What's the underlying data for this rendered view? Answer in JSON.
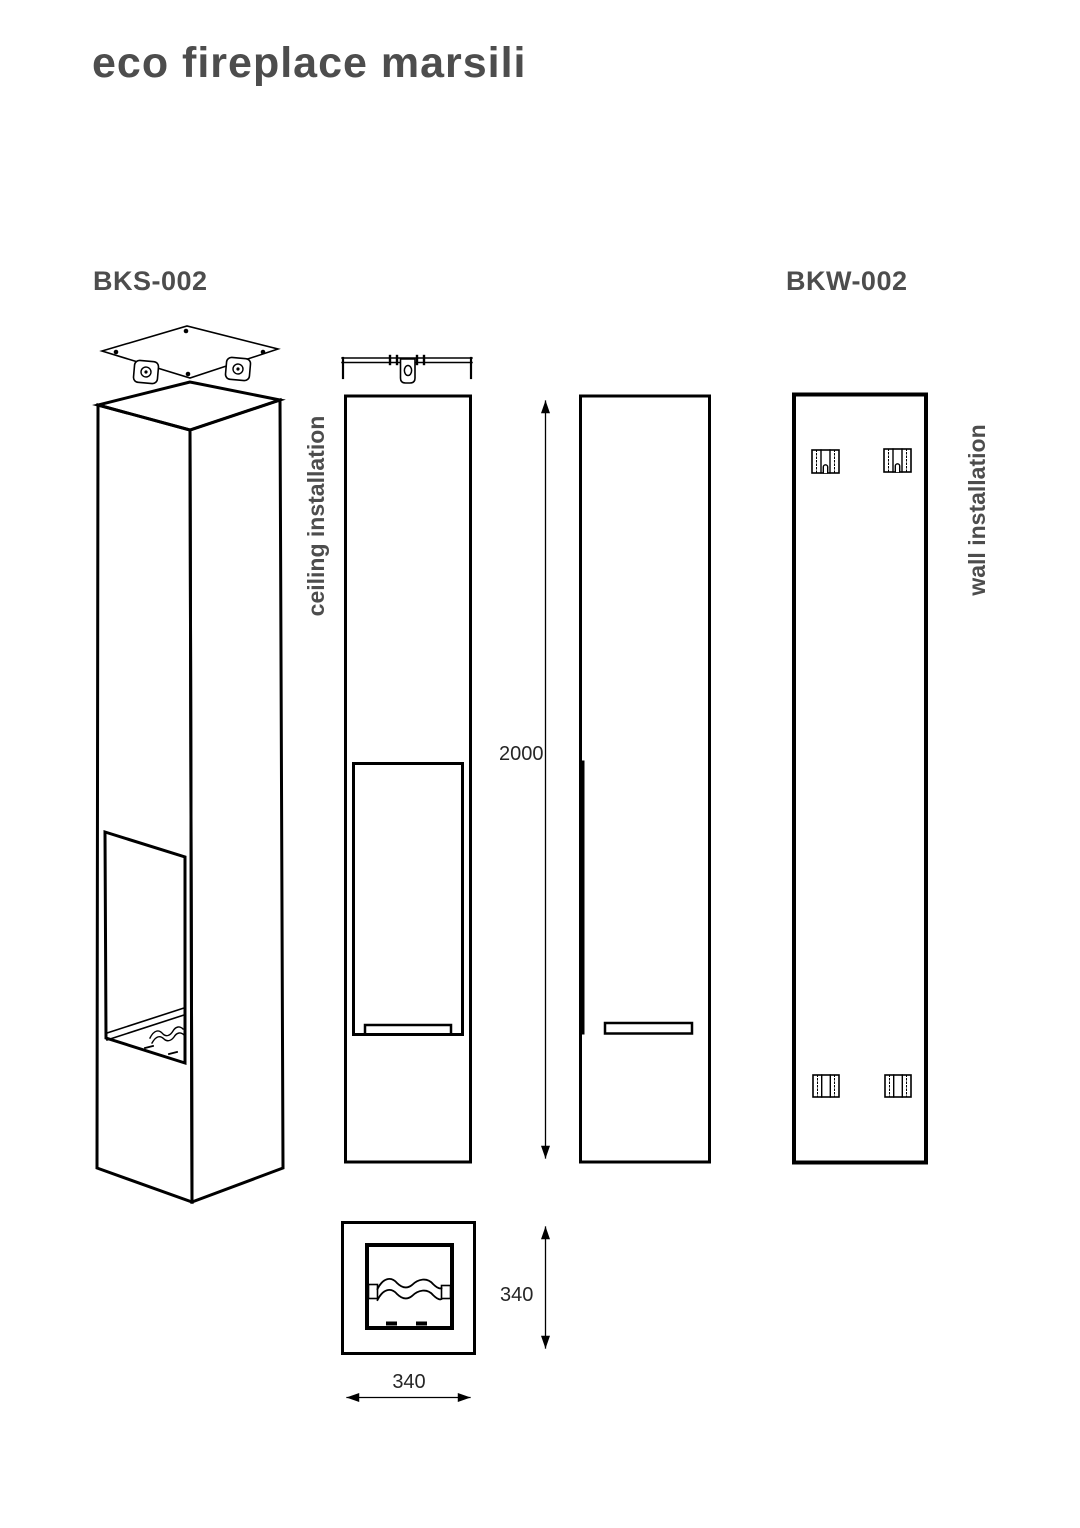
{
  "page": {
    "title": "eco fireplace marsili"
  },
  "models": {
    "bks": {
      "code": "BKS-002",
      "installation": "ceiling installation"
    },
    "bkw": {
      "code": "BKW-002",
      "installation": "wall installation"
    }
  },
  "dimensions": {
    "height": "2000",
    "depth": "340",
    "width": "340"
  },
  "colors": {
    "line": "#000000",
    "heading_text": "#4d4d4d",
    "dimension_text": "#262626",
    "background": "#ffffff"
  }
}
